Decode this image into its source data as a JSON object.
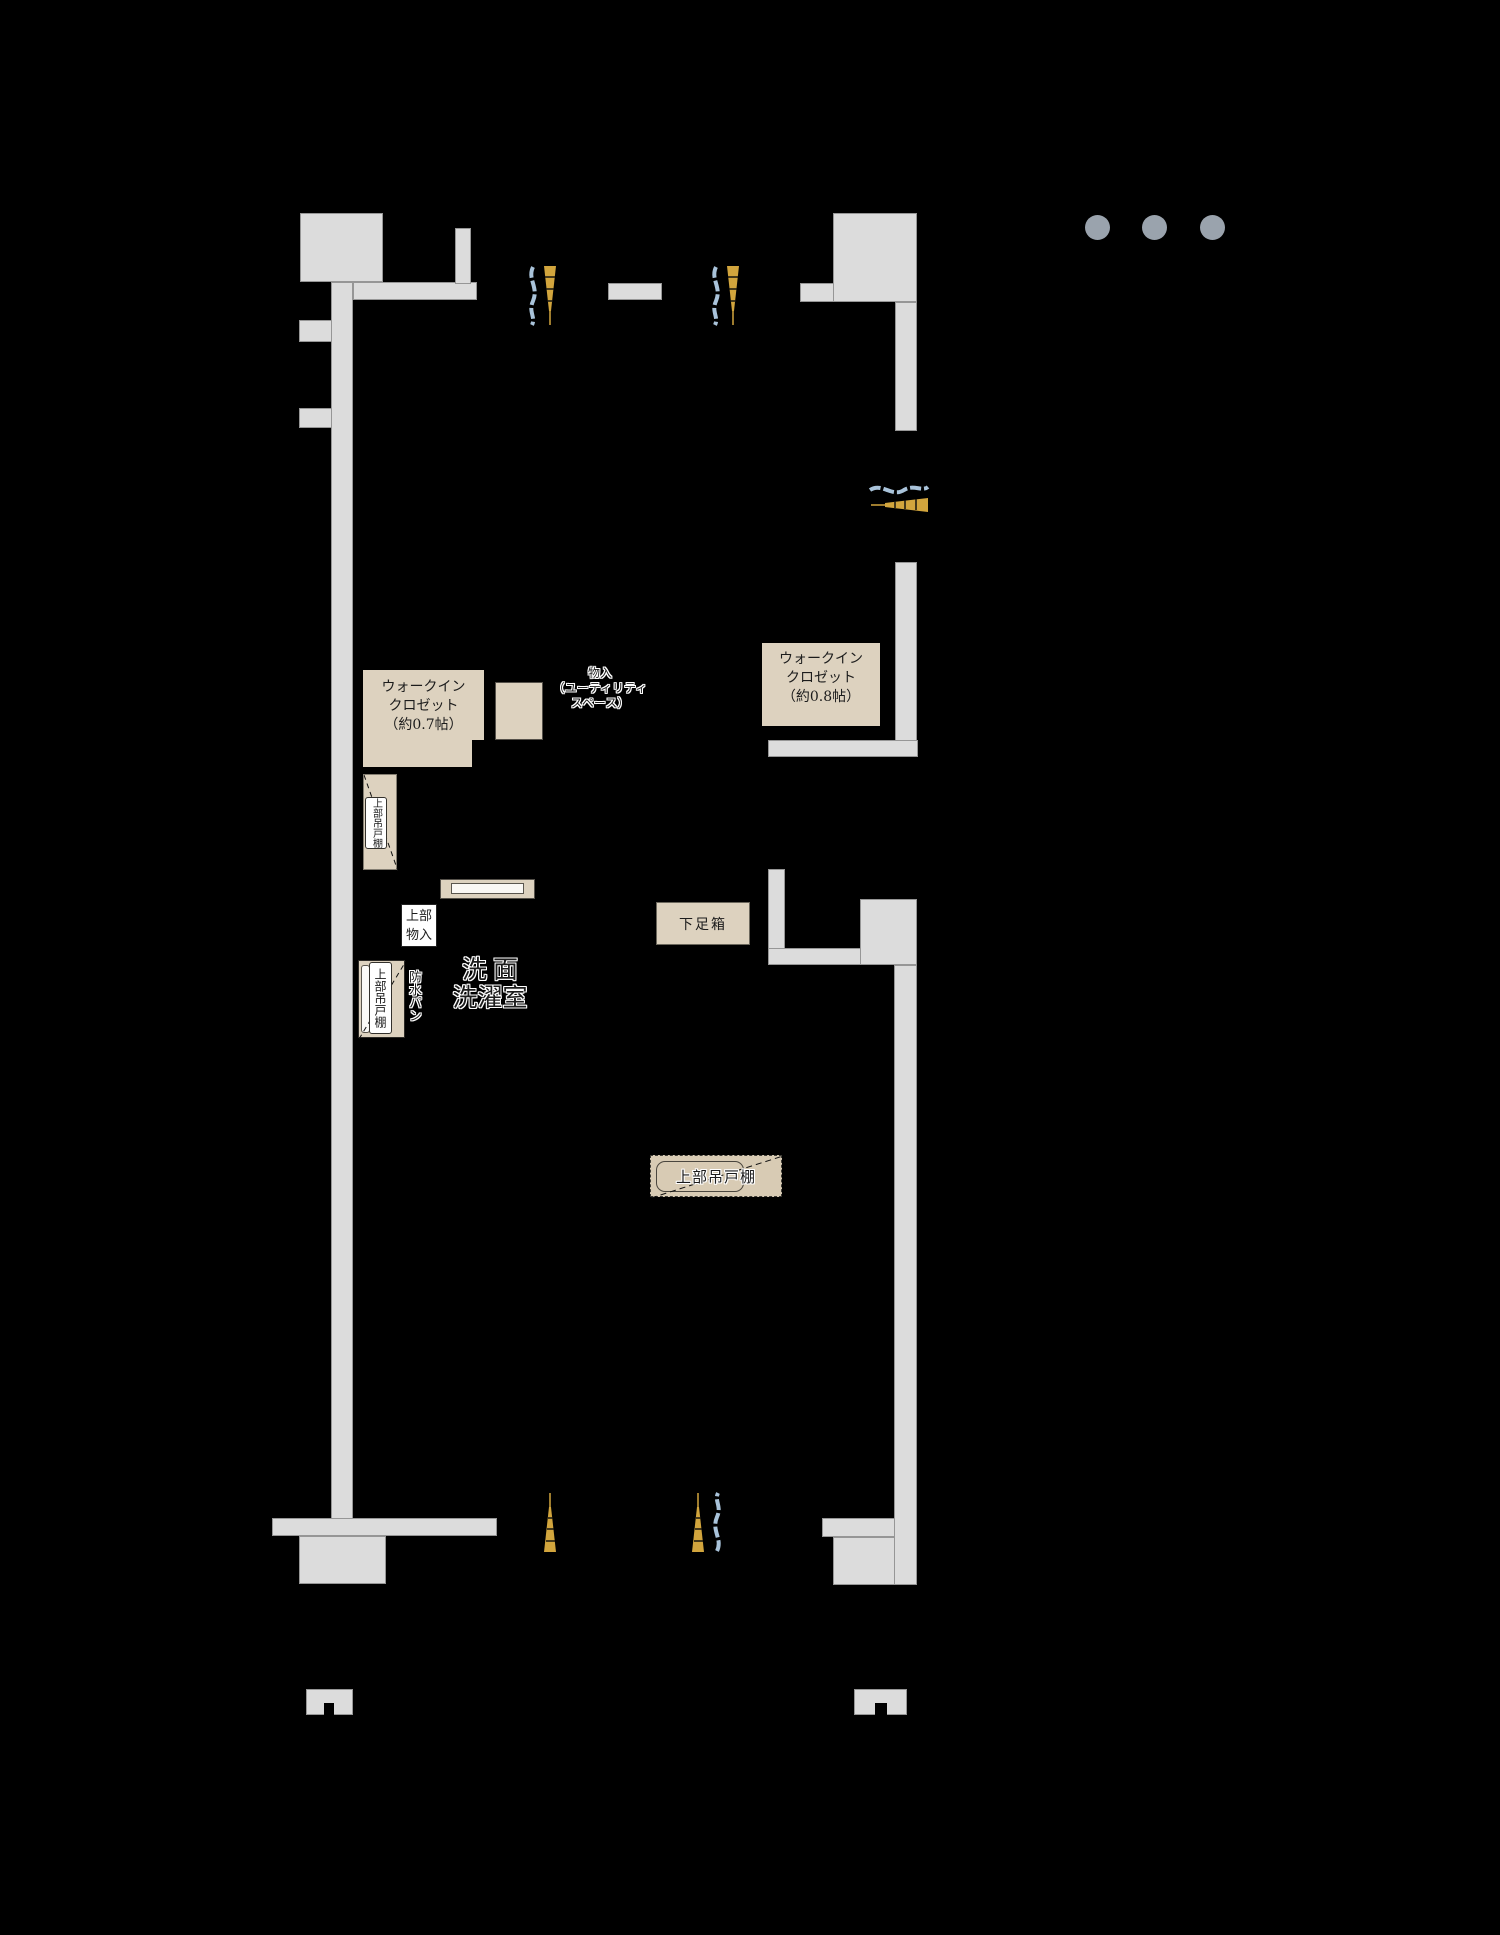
{
  "title": "マンション間取り図（部分）",
  "colors": {
    "background": "#000000",
    "wall": "#dcdcdc",
    "wall_border": "#969696",
    "furniture": "#ddd2bf",
    "furniture_border": "#55514a",
    "badge_bg": "#ffffff",
    "text": "#1c1c1c",
    "dot": "#9aa3ad",
    "window_blue": "#a9c3da",
    "window_gold": "#d2a53d"
  },
  "rooms": {
    "wic_left": {
      "line1": "ウォークイン",
      "line2": "クロゼット",
      "line3": "（約0.7帖）"
    },
    "wic_right": {
      "line1": "ウォークイン",
      "line2": "クロゼット",
      "line3": "（約0.8帖）"
    },
    "utility": {
      "line1": "物入",
      "line2": "（ユーティリティ",
      "line3": "スペース）"
    },
    "washroom": {
      "line1": "洗面",
      "line2": "洗濯室"
    }
  },
  "fixtures": {
    "hanging_cabinet": "上部吊戸棚",
    "upper_storage": {
      "line1": "上部",
      "line2": "物入"
    },
    "waterproof_pan": "防水パン",
    "shoe_box": "下足箱"
  }
}
